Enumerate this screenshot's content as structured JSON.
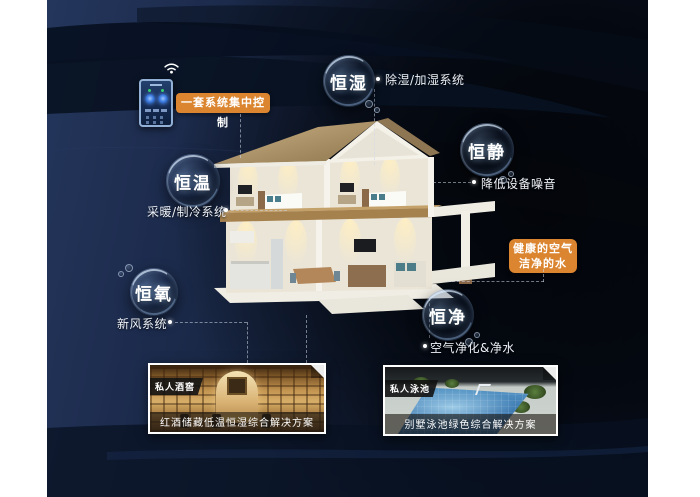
{
  "control": {
    "label": "一套系统集中控制"
  },
  "bubbles": {
    "humidity": {
      "label": "恒湿",
      "note": "除湿/加湿系统"
    },
    "quiet": {
      "label": "恒静",
      "note": "降低设备噪音"
    },
    "temperature": {
      "label": "恒温",
      "note": "采暖/制冷系统"
    },
    "oxygen": {
      "label": "恒氧",
      "note": "新风系统"
    },
    "purity": {
      "label": "恒净",
      "note": "空气净化&净水"
    }
  },
  "highlight": {
    "line1": "健康的空气",
    "line2": "洁净的水"
  },
  "photos": {
    "wine": {
      "tag": "私人酒窖",
      "caption": "红酒储藏低温恒湿综合解决方案"
    },
    "pool": {
      "tag": "私人泳池",
      "caption": "别墅泳池绿色综合解决方案"
    }
  },
  "colors": {
    "accent_orange": "#DB8530",
    "background_navy": "#1D2C4E",
    "background_dark": "#05080F",
    "text_light": "#FFFFFF"
  }
}
